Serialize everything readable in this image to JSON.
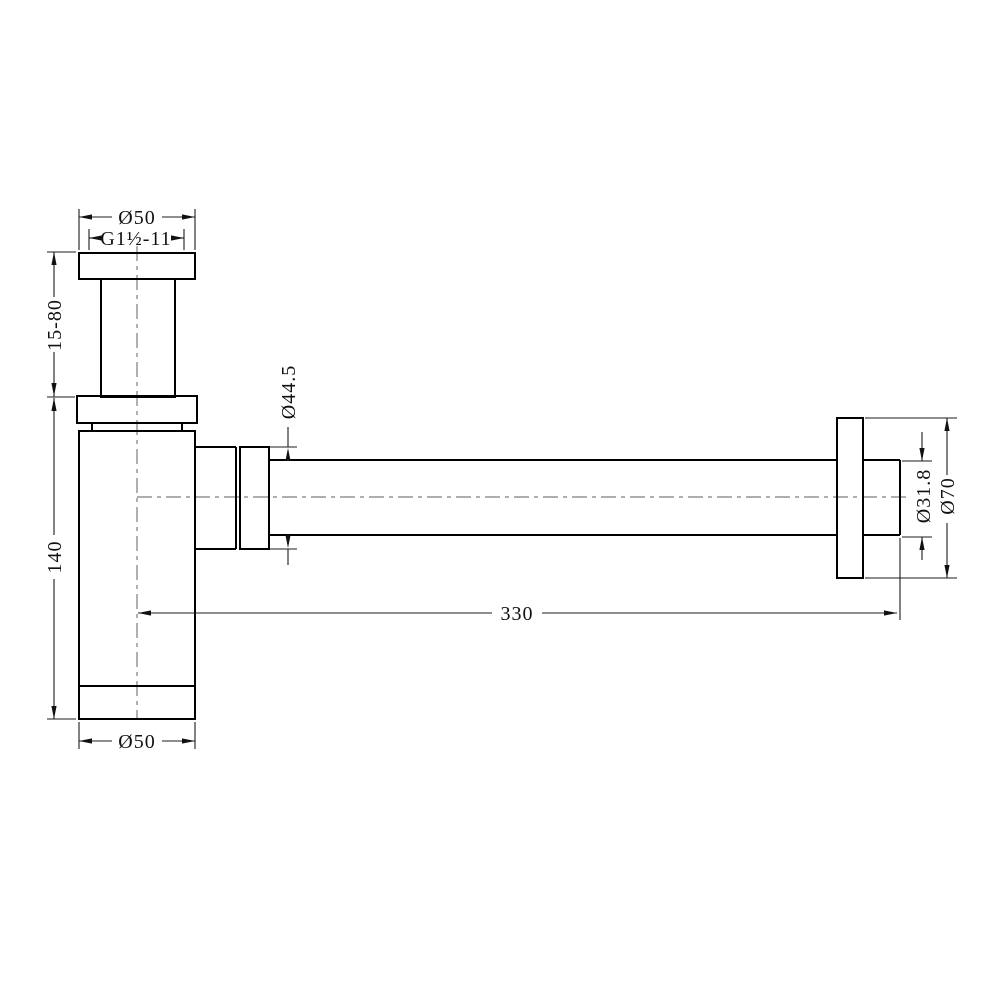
{
  "colors": {
    "background": "#ffffff",
    "line": "#000000",
    "centerline": "#7d7d7d"
  },
  "drawing": {
    "labels": {
      "top_diameter": "Ø50",
      "thread": "G1½-11",
      "height_range": "15-80",
      "body_height": "140",
      "nut_diameter": "Ø44.5",
      "length": "330",
      "pipe_diameter": "Ø31.8",
      "flange_diameter": "Ø70",
      "bottom_diameter": "Ø50"
    }
  }
}
